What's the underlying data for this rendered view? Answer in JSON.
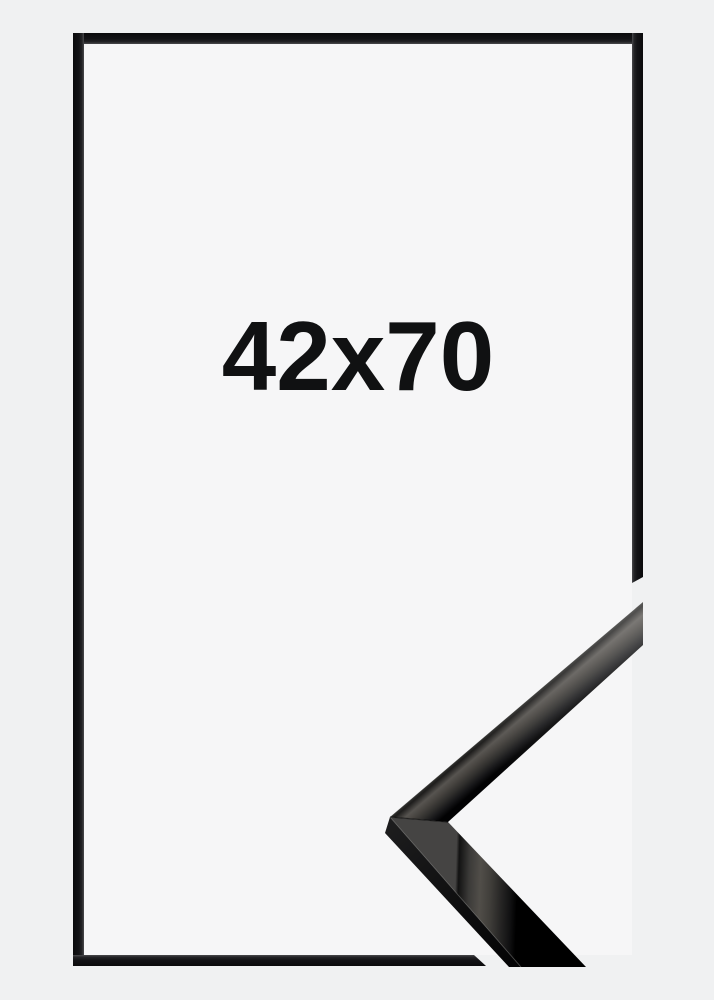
{
  "product_image": {
    "size_label": "42x70",
    "colors": {
      "background": "#f0f1f2",
      "frame_opening": "#f6f6f7",
      "frame_outline": "#141416",
      "label_text": "#101112",
      "moulding_dark": "#050506",
      "moulding_highlight": "#565350"
    },
    "icons": {
      "corner_sample": "frame-corner-sample"
    }
  }
}
